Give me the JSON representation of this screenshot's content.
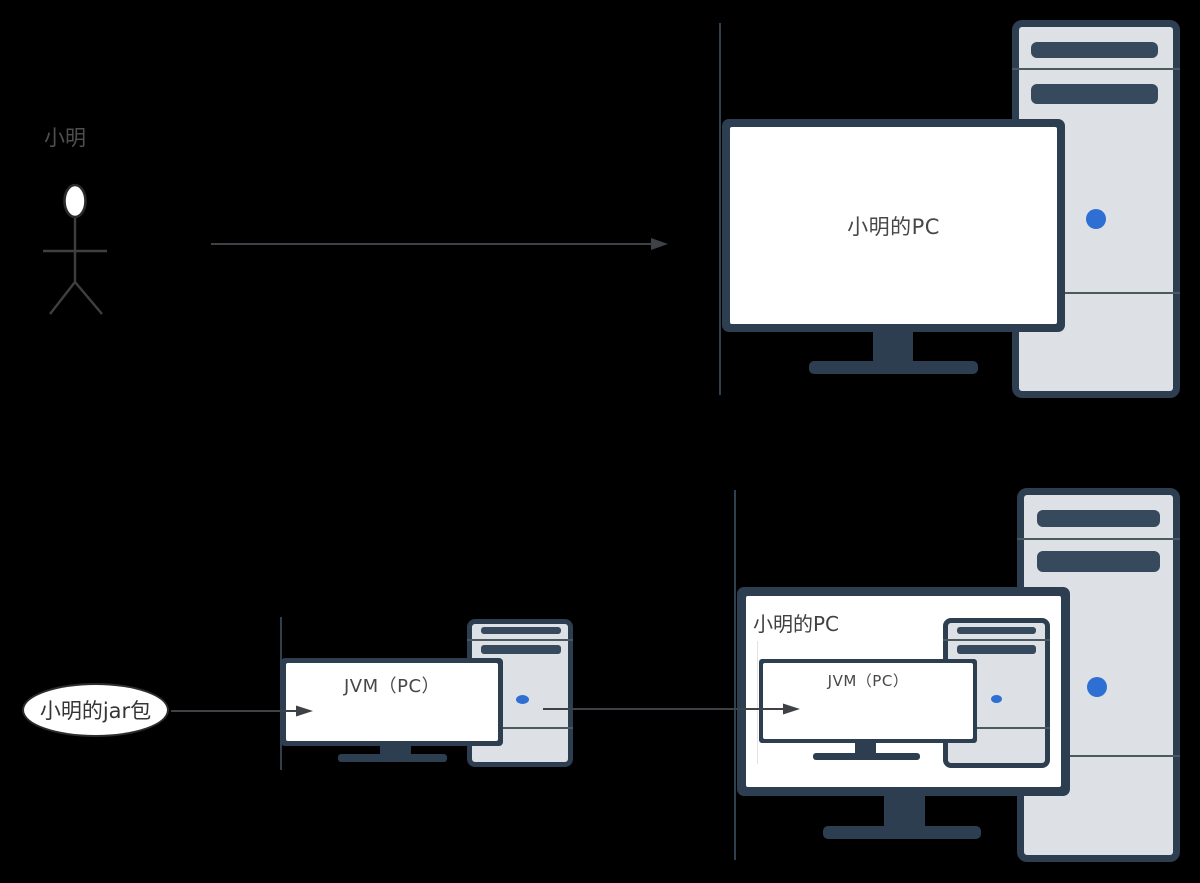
{
  "diagram": {
    "description_type": "architecture-flow-diagram",
    "background": "#000000"
  },
  "palette": {
    "background": "#000000",
    "frame_navy": "#2c3e50",
    "slot_navy": "#37495c",
    "tower_divider": "#4b5a5f",
    "tower_body": "#dde1e6",
    "power_button_blue": "#2e6fd4",
    "arrow_gray": "#3e4246",
    "section_line": "#31404f",
    "label_gray": "#4f4f4f",
    "screen_text_gray": "#474747",
    "screen_white": "#ffffff"
  },
  "icons": {
    "actor": "stick-figure-icon",
    "computer_case": "desktop-tower-icon",
    "display": "monitor-icon",
    "power": "power-button-icon",
    "flow": "right-arrow-icon"
  },
  "top_section": {
    "actor_label": "小明",
    "pc_screen_label": "小明的PC"
  },
  "bottom_section": {
    "jar_label": "小明的jar包",
    "jvm_screen_label": "JVM（PC）",
    "host_pc_label": "小明的PC",
    "nested_jvm_screen_label": "JVM（PC）"
  }
}
